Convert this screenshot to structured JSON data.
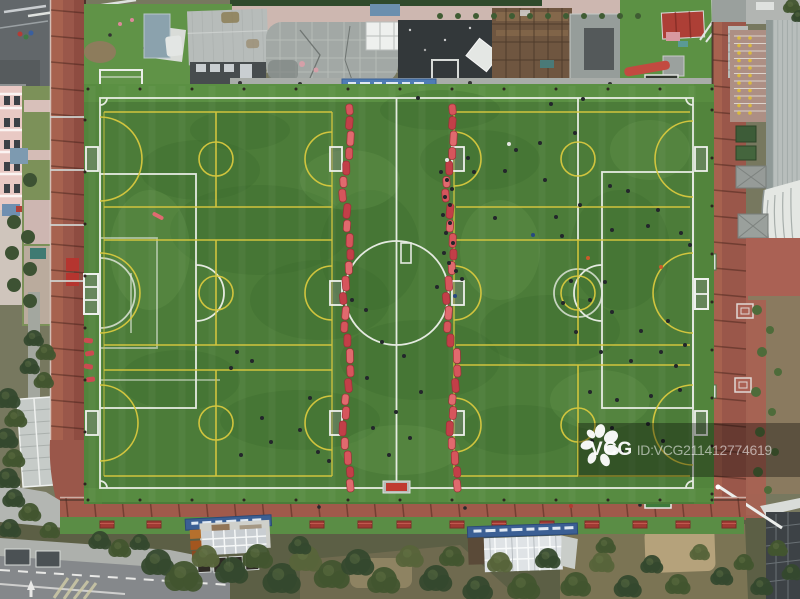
{
  "watermark": {
    "logo_text": "VCG",
    "id_text": "ID:VCG211412774619"
  },
  "scene": {
    "description": "Aerial top-down view of a green artificial-turf football complex divided by two red barrier chains into training pitches, surrounded by a maroon running track, school buildings, stands, trees and a road",
    "palette": {
      "turf": "#4c7c39",
      "turf_bright": "#5d9245",
      "white_line": "#f2f4ef",
      "yellow_line": "#d9c93f",
      "barrier_red": "#d6555c",
      "track": "#9a574a",
      "pavement": "#aa6154",
      "road": "#85888b",
      "tree": "#42552f",
      "dirt": "#8a7a5f",
      "watermark_band": "rgba(0,0,0,0.33)"
    },
    "people": [
      [
        551,
        104
      ],
      [
        583,
        99
      ],
      [
        575,
        133
      ],
      [
        540,
        143
      ],
      [
        516,
        150
      ],
      [
        505,
        171
      ],
      [
        468,
        158
      ],
      [
        474,
        172
      ],
      [
        545,
        180
      ],
      [
        610,
        186
      ],
      [
        628,
        191
      ],
      [
        580,
        205
      ],
      [
        556,
        217
      ],
      [
        495,
        218
      ],
      [
        533,
        235,
        1
      ],
      [
        562,
        236
      ],
      [
        612,
        230
      ],
      [
        648,
        226
      ],
      [
        681,
        233
      ],
      [
        658,
        210
      ],
      [
        690,
        245
      ],
      [
        441,
        172
      ],
      [
        447,
        180
      ],
      [
        452,
        189
      ],
      [
        445,
        197
      ],
      [
        450,
        205
      ],
      [
        443,
        215
      ],
      [
        450,
        223
      ],
      [
        446,
        233
      ],
      [
        453,
        243
      ],
      [
        444,
        253
      ],
      [
        449,
        263
      ],
      [
        456,
        271
      ],
      [
        462,
        279
      ],
      [
        437,
        287
      ],
      [
        455,
        296,
        1
      ],
      [
        447,
        160,
        2
      ],
      [
        571,
        281
      ],
      [
        605,
        282
      ],
      [
        563,
        303
      ],
      [
        590,
        300
      ],
      [
        612,
        312
      ],
      [
        576,
        332
      ],
      [
        641,
        331
      ],
      [
        668,
        321
      ],
      [
        601,
        352
      ],
      [
        631,
        361
      ],
      [
        661,
        352
      ],
      [
        685,
        345
      ],
      [
        590,
        392
      ],
      [
        617,
        400
      ],
      [
        651,
        396
      ],
      [
        680,
        390
      ],
      [
        612,
        428
      ],
      [
        648,
        424
      ],
      [
        592,
        441
      ],
      [
        663,
        441
      ],
      [
        622,
        452
      ],
      [
        676,
        366
      ],
      [
        509,
        144,
        2
      ],
      [
        382,
        342
      ],
      [
        404,
        356
      ],
      [
        367,
        378
      ],
      [
        421,
        392
      ],
      [
        396,
        412
      ],
      [
        373,
        428
      ],
      [
        410,
        438
      ],
      [
        389,
        455
      ],
      [
        352,
        300
      ],
      [
        366,
        310
      ],
      [
        418,
        98
      ],
      [
        237,
        352
      ],
      [
        252,
        361
      ],
      [
        231,
        368
      ],
      [
        262,
        418
      ],
      [
        300,
        430
      ],
      [
        271,
        442
      ],
      [
        318,
        452
      ],
      [
        241,
        455
      ],
      [
        329,
        461
      ],
      [
        310,
        398
      ],
      [
        588,
        258,
        3
      ],
      [
        661,
        267,
        3
      ]
    ],
    "trees": [
      [
        158,
        562,
        13,
        0
      ],
      [
        184,
        576,
        15,
        1
      ],
      [
        206,
        556,
        11,
        2
      ],
      [
        232,
        570,
        13,
        0
      ],
      [
        258,
        556,
        12,
        1
      ],
      [
        282,
        578,
        15,
        0
      ],
      [
        306,
        558,
        13,
        2
      ],
      [
        332,
        574,
        14,
        1
      ],
      [
        300,
        545,
        9,
        0
      ],
      [
        358,
        562,
        13,
        0
      ],
      [
        384,
        580,
        13,
        1
      ],
      [
        410,
        556,
        11,
        2
      ],
      [
        436,
        578,
        13,
        0
      ],
      [
        452,
        556,
        10,
        1
      ],
      [
        478,
        588,
        12,
        0
      ],
      [
        500,
        562,
        10,
        2
      ],
      [
        524,
        586,
        13,
        1
      ],
      [
        548,
        558,
        10,
        0
      ],
      [
        576,
        584,
        12,
        1
      ],
      [
        602,
        562,
        10,
        2
      ],
      [
        628,
        586,
        11,
        0
      ],
      [
        606,
        545,
        8,
        1
      ],
      [
        652,
        564,
        9,
        0
      ],
      [
        678,
        584,
        10,
        1
      ],
      [
        700,
        552,
        8,
        2
      ],
      [
        722,
        576,
        9,
        0
      ],
      [
        744,
        562,
        8,
        1
      ],
      [
        762,
        586,
        9,
        0
      ],
      [
        778,
        548,
        8,
        1
      ],
      [
        792,
        572,
        8,
        0
      ],
      [
        8,
        398,
        10,
        0
      ],
      [
        16,
        418,
        9,
        1
      ],
      [
        6,
        438,
        10,
        0
      ],
      [
        14,
        458,
        9,
        1
      ],
      [
        8,
        478,
        10,
        0
      ],
      [
        34,
        338,
        8,
        0
      ],
      [
        46,
        352,
        8,
        1
      ],
      [
        30,
        366,
        8,
        0
      ],
      [
        44,
        380,
        8,
        1
      ],
      [
        14,
        498,
        9,
        0
      ],
      [
        30,
        512,
        9,
        1
      ],
      [
        10,
        528,
        9,
        0
      ],
      [
        50,
        530,
        8,
        1
      ],
      [
        100,
        540,
        9,
        0
      ],
      [
        120,
        548,
        9,
        1
      ],
      [
        140,
        542,
        8,
        0
      ],
      [
        792,
        6,
        7,
        1
      ],
      [
        799,
        16,
        6,
        0
      ]
    ],
    "bushes": [
      [
        30,
        180,
        7
      ],
      [
        14,
        222,
        7
      ],
      [
        28,
        237,
        7
      ],
      [
        12,
        253,
        7
      ],
      [
        30,
        269,
        7
      ],
      [
        14,
        285,
        7
      ],
      [
        30,
        301,
        7
      ]
    ],
    "shrubs": [
      [
        757,
        310,
        5
      ],
      [
        770,
        330,
        4
      ],
      [
        762,
        352,
        5
      ],
      [
        778,
        372,
        4
      ],
      [
        756,
        392,
        5
      ],
      [
        772,
        412,
        4
      ],
      [
        760,
        432,
        5
      ],
      [
        775,
        452,
        4
      ],
      [
        758,
        472,
        5
      ],
      [
        768,
        490,
        4
      ]
    ],
    "benches_x": [
      100,
      147,
      193,
      254,
      310,
      358,
      397,
      450,
      492,
      540,
      585,
      633,
      676,
      722
    ],
    "mottle_dark": [
      [
        260,
        230,
        90,
        45
      ],
      [
        200,
        170,
        60,
        30
      ],
      [
        320,
        300,
        70,
        40
      ],
      [
        420,
        360,
        80,
        40
      ],
      [
        370,
        250,
        50,
        60
      ],
      [
        480,
        160,
        60,
        30
      ],
      [
        550,
        330,
        70,
        35
      ],
      [
        300,
        420,
        80,
        30
      ],
      [
        620,
        250,
        50,
        60
      ],
      [
        180,
        380,
        60,
        30
      ],
      [
        520,
        430,
        60,
        25
      ],
      [
        240,
        130,
        50,
        20
      ],
      [
        440,
        110,
        60,
        20
      ]
    ],
    "mottle_light": [
      [
        150,
        250,
        40,
        60
      ],
      [
        350,
        180,
        50,
        30
      ],
      [
        500,
        250,
        40,
        50
      ],
      [
        600,
        400,
        50,
        30
      ],
      [
        400,
        450,
        60,
        25
      ],
      [
        650,
        150,
        40,
        30
      ]
    ]
  }
}
